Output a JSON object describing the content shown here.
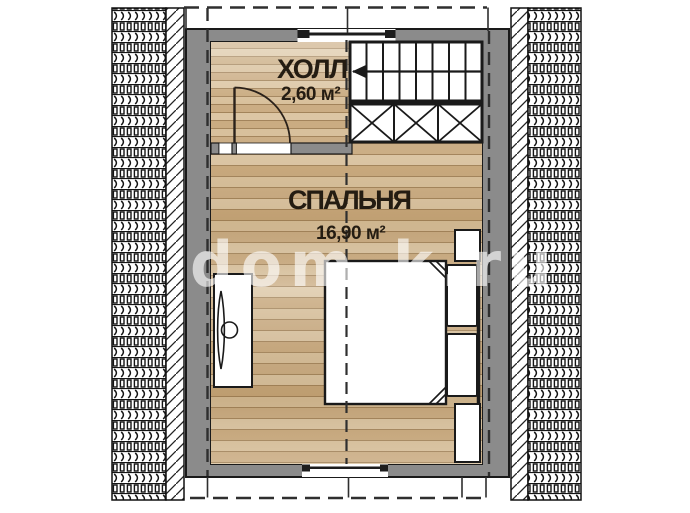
{
  "plan_title": "attic-floor-plan",
  "rooms": [
    {
      "id": "hall",
      "name": "ХОЛЛ",
      "area": "2,60 м²"
    },
    {
      "id": "bedroom",
      "name": "СПАЛЬНЯ",
      "area": "16,90 м²"
    }
  ],
  "watermark": "dom-k.ru",
  "colors": {
    "wall": "#8b8b8b",
    "floor_light": "#dcc6a4",
    "floor_dark": "#c8a87c",
    "line": "#1c1c1c",
    "label_text": "#241c12",
    "watermark": "rgba(255,255,255,0.62)"
  }
}
